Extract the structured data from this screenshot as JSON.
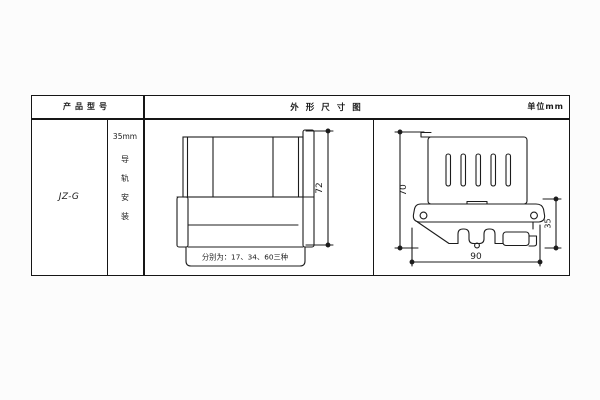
{
  "header": {
    "product_model_label": "产品型号",
    "title": "外形尺寸图",
    "unit_label": "单位mm"
  },
  "left_panel": {
    "model": "JZ-G",
    "rail_spec": "35mm",
    "mount_chars": [
      "导",
      "轨",
      "安",
      "装"
    ]
  },
  "front_view": {
    "height_dim": "72",
    "width_note": "分别为：17、34、60三种"
  },
  "side_view": {
    "height_dim": "70",
    "clip_dim": "35",
    "width_dim": "90"
  },
  "colors": {
    "line": "#1c1c1c",
    "background": "#fcfcfc"
  }
}
